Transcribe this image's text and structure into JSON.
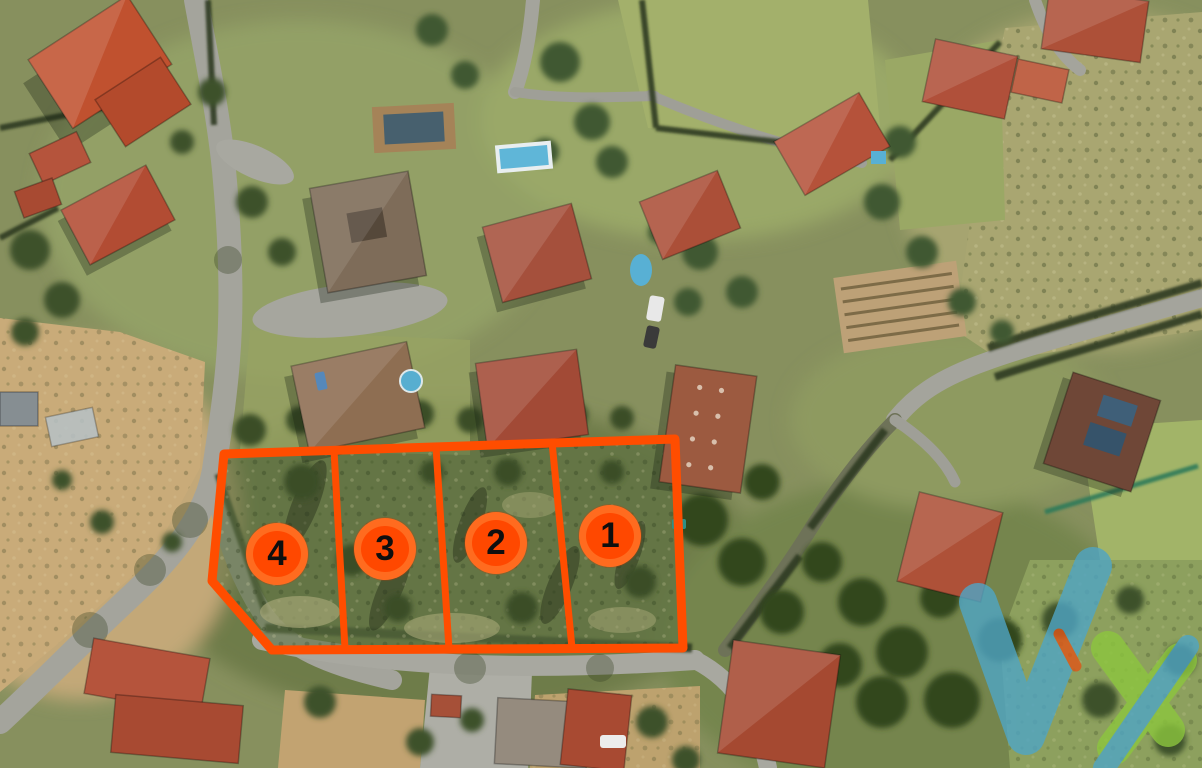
{
  "image": {
    "description": "Aerial satellite photo of a residential area with four land parcels outlined in orange"
  },
  "plots": [
    {
      "number": "1"
    },
    {
      "number": "2"
    },
    {
      "number": "3"
    },
    {
      "number": "4"
    }
  ],
  "overlay": {
    "outline_color": "#FF4D00",
    "badge_ring_color": "#FF6B1F",
    "badge_fill_color": "#FF4800",
    "badge_text_color": "#0F0F0F"
  },
  "watermark": {
    "check_color": "#4FA5C5",
    "star_color": "#8CC63E",
    "accent_color": "#E05617"
  }
}
